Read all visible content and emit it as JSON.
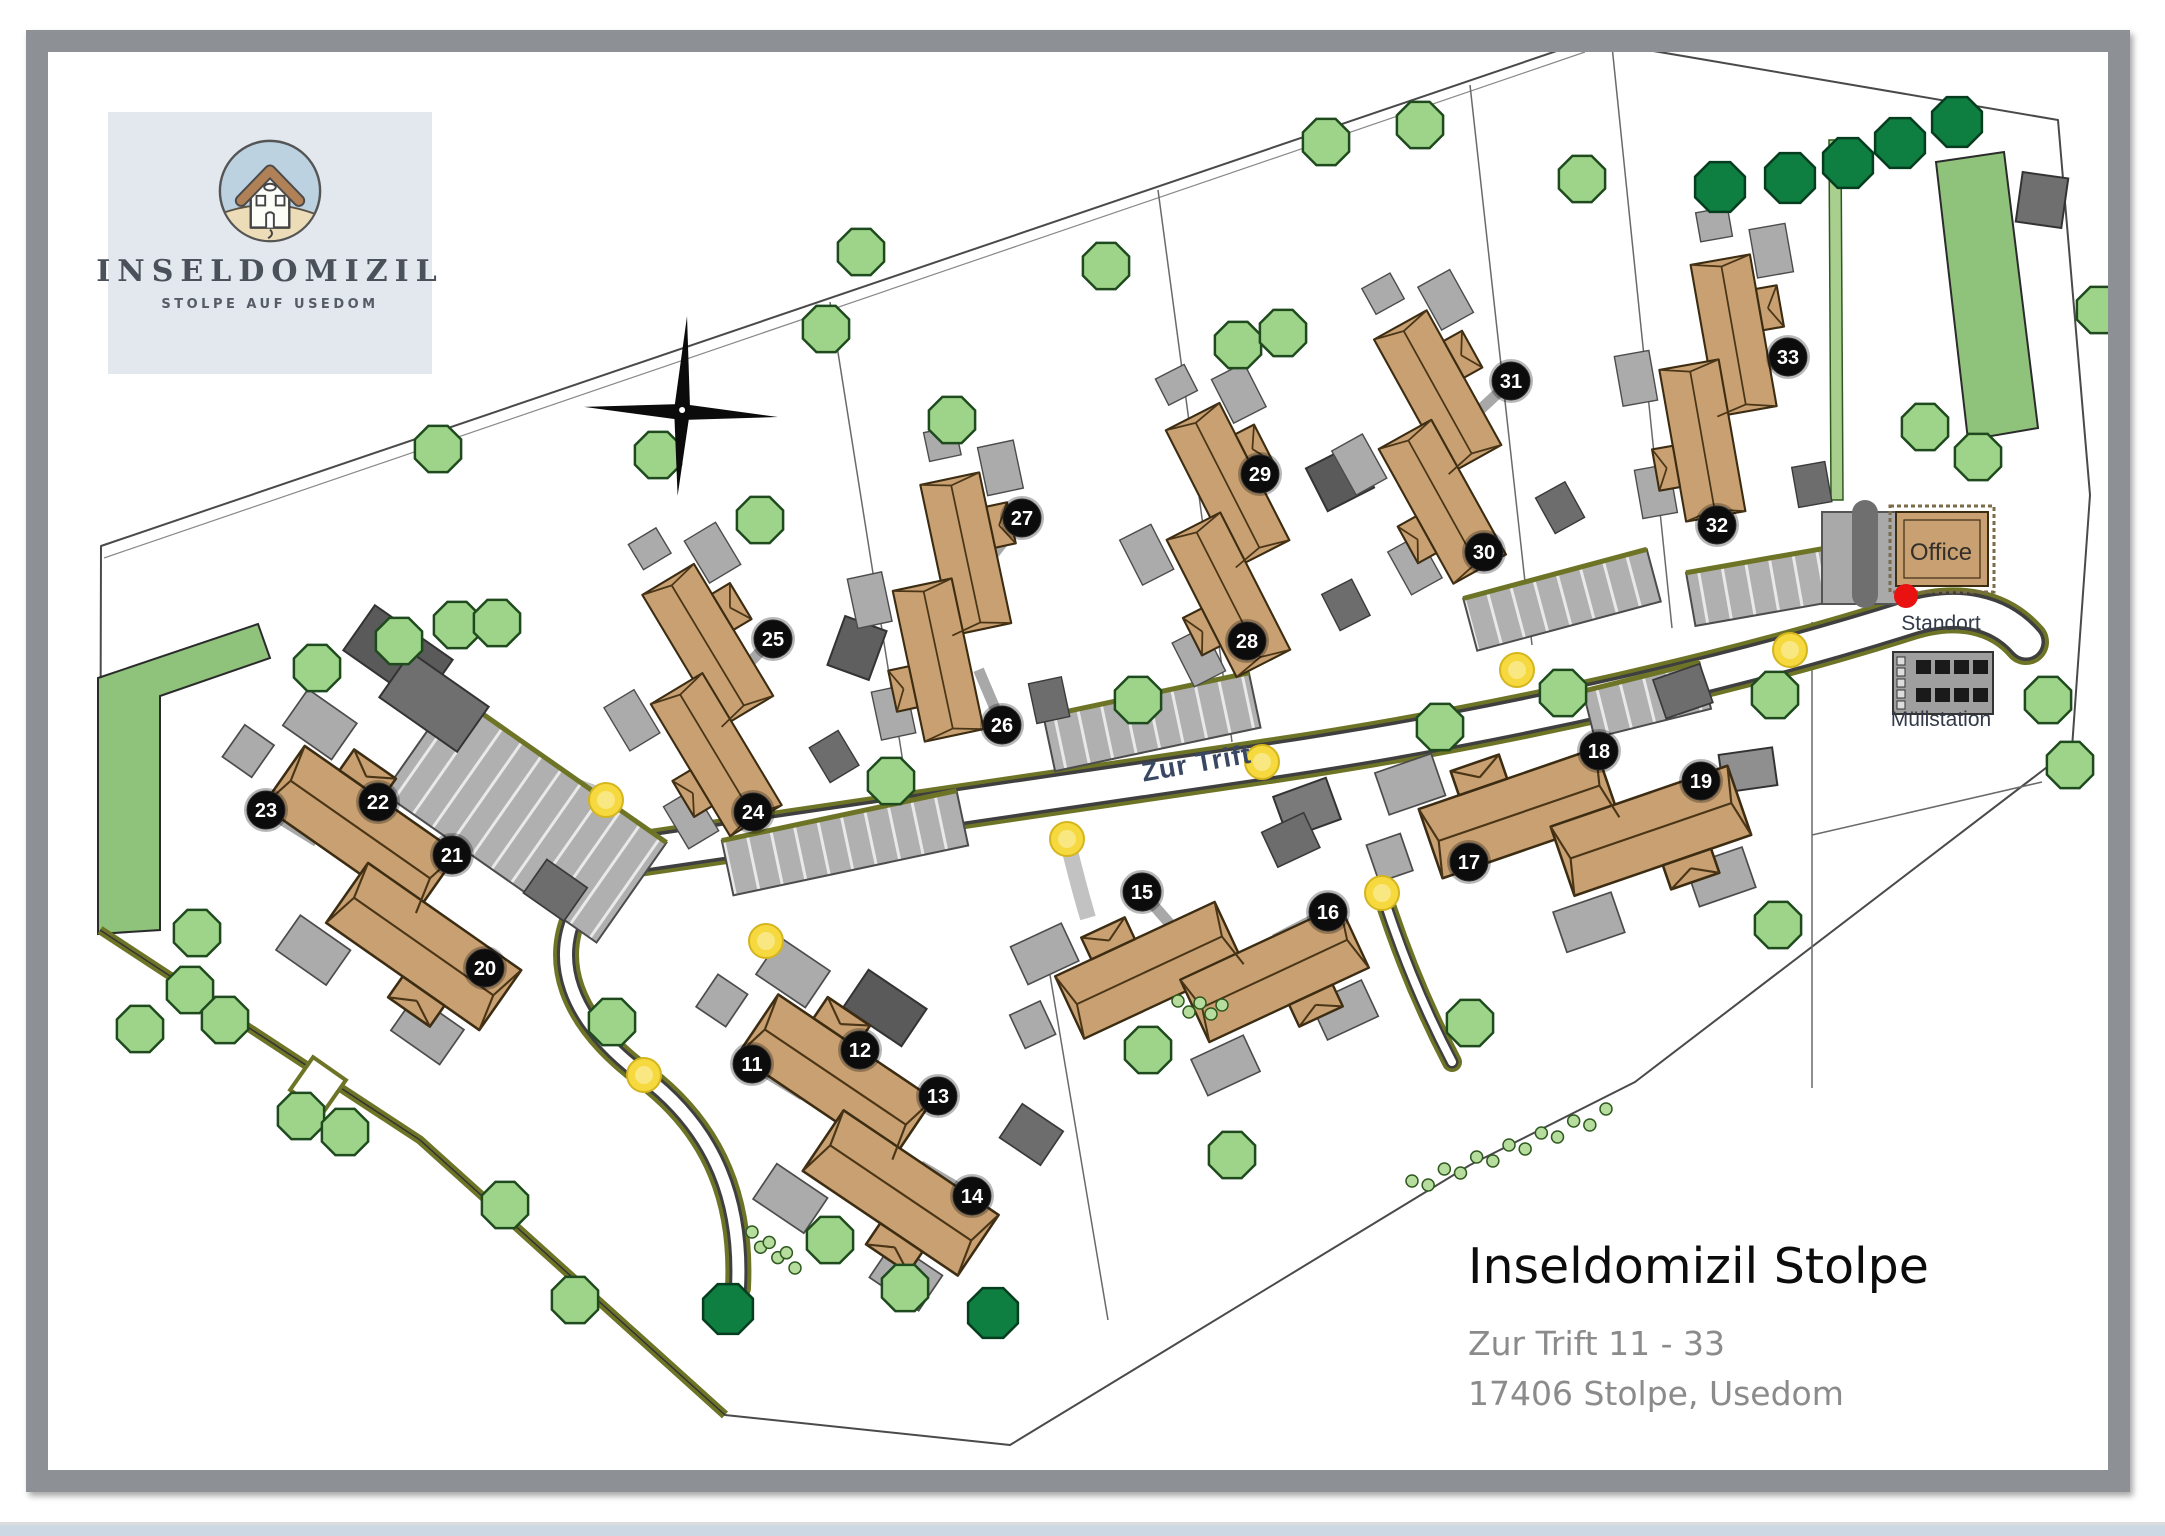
{
  "logo": {
    "title": "INSELDOMIZIL",
    "subtitle": "STOLPE AUF USEDOM"
  },
  "title_block": {
    "title": "Inseldomizil Stolpe",
    "address_line1": "Zur Trift 11 - 33",
    "address_line2": "17406 Stolpe, Usedom"
  },
  "map": {
    "labels": [
      {
        "text": "Zur Trift",
        "x": 1198,
        "y": 772,
        "rot": -10,
        "size": 27,
        "color": "#3a4763",
        "weight": "bold",
        "spacing": 1
      },
      {
        "text": "Office",
        "x": 1941,
        "y": 560,
        "rot": 0,
        "size": 24,
        "color": "#33302a",
        "weight": "normal",
        "spacing": 0
      },
      {
        "text": "Standort",
        "x": 1941,
        "y": 630,
        "rot": 0,
        "size": 21,
        "color": "#333a4a",
        "weight": "normal",
        "spacing": 0
      },
      {
        "text": "Müllstation",
        "x": 1941,
        "y": 726,
        "rot": 0,
        "size": 21,
        "color": "#333a4a",
        "weight": "normal",
        "spacing": 0
      }
    ],
    "markers": [
      {
        "n": "11",
        "x": 752,
        "y": 1064
      },
      {
        "n": "12",
        "x": 860,
        "y": 1050
      },
      {
        "n": "13",
        "x": 938,
        "y": 1096
      },
      {
        "n": "14",
        "x": 972,
        "y": 1196
      },
      {
        "n": "15",
        "x": 1142,
        "y": 892
      },
      {
        "n": "16",
        "x": 1328,
        "y": 912
      },
      {
        "n": "17",
        "x": 1469,
        "y": 862
      },
      {
        "n": "18",
        "x": 1599,
        "y": 751
      },
      {
        "n": "19",
        "x": 1701,
        "y": 781
      },
      {
        "n": "20",
        "x": 485,
        "y": 968
      },
      {
        "n": "21",
        "x": 452,
        "y": 855
      },
      {
        "n": "22",
        "x": 378,
        "y": 802
      },
      {
        "n": "23",
        "x": 266,
        "y": 810
      },
      {
        "n": "24",
        "x": 753,
        "y": 812
      },
      {
        "n": "25",
        "x": 773,
        "y": 639
      },
      {
        "n": "26",
        "x": 1002,
        "y": 725
      },
      {
        "n": "27",
        "x": 1022,
        "y": 518
      },
      {
        "n": "28",
        "x": 1247,
        "y": 641
      },
      {
        "n": "29",
        "x": 1260,
        "y": 474
      },
      {
        "n": "30",
        "x": 1484,
        "y": 552
      },
      {
        "n": "31",
        "x": 1511,
        "y": 381
      },
      {
        "n": "32",
        "x": 1717,
        "y": 525
      },
      {
        "n": "33",
        "x": 1788,
        "y": 357
      }
    ],
    "lamps": [
      [
        606,
        800
      ],
      [
        766,
        941
      ],
      [
        644,
        1075
      ],
      [
        1067,
        839
      ],
      [
        1262,
        762
      ],
      [
        1382,
        893
      ],
      [
        1517,
        670
      ],
      [
        1790,
        650
      ]
    ],
    "buildings": [
      {
        "x": 868,
        "y": 1135,
        "rot": 34,
        "s": 0.85
      },
      {
        "x": 1212,
        "y": 972,
        "rot": -25,
        "s": 0.8
      },
      {
        "x": 1585,
        "y": 822,
        "rot": -19,
        "s": 0.85
      },
      {
        "x": 392,
        "y": 888,
        "rot": 35,
        "s": 0.85
      },
      {
        "x": 712,
        "y": 700,
        "rot": 59,
        "s": 0.7
      },
      {
        "x": 952,
        "y": 607,
        "rot": 78,
        "s": 0.7
      },
      {
        "x": 1228,
        "y": 540,
        "rot": 63,
        "s": 0.7
      },
      {
        "x": 1440,
        "y": 447,
        "rot": 61,
        "s": 0.7
      },
      {
        "x": 1718,
        "y": 388,
        "rot": 80,
        "s": 0.7
      }
    ],
    "parking_strips": [
      {
        "x": 525,
        "y": 818,
        "l": 260,
        "t": 122,
        "rot": 35
      },
      {
        "x": 845,
        "y": 843,
        "l": 240,
        "t": 56,
        "rot": -12
      },
      {
        "x": 1152,
        "y": 722,
        "l": 210,
        "t": 56,
        "rot": -12
      },
      {
        "x": 1562,
        "y": 600,
        "l": 190,
        "t": 54,
        "rot": -15
      },
      {
        "x": 1772,
        "y": 585,
        "l": 165,
        "t": 54,
        "rot": -10
      },
      {
        "x": 1647,
        "y": 700,
        "l": 120,
        "t": 48,
        "rot": -14
      }
    ],
    "garages": [
      [
        398,
        655,
        95,
        55,
        35,
        "#5a5a5a"
      ],
      [
        434,
        702,
        95,
        55,
        35,
        "#6f6f6f"
      ],
      [
        857,
        648,
        44,
        52,
        20,
        "#5f5f5f"
      ],
      [
        1340,
        478,
        48,
        52,
        63,
        "#5a5a5a"
      ],
      [
        2042,
        200,
        46,
        50,
        8,
        "#6f6f6f"
      ],
      [
        1748,
        770,
        54,
        38,
        -8,
        "#8f8f8f"
      ],
      [
        885,
        1008,
        70,
        45,
        34,
        "#5a5a5a"
      ],
      [
        1307,
        808,
        56,
        44,
        -20,
        "#7a7a7a"
      ]
    ],
    "trees_light": [
      [
        317,
        668
      ],
      [
        457,
        625
      ],
      [
        497,
        623
      ],
      [
        197,
        933
      ],
      [
        190,
        990
      ],
      [
        225,
        1020
      ],
      [
        301,
        1116
      ],
      [
        345,
        1132
      ],
      [
        140,
        1029
      ],
      [
        399,
        641
      ],
      [
        438,
        449
      ],
      [
        658,
        455
      ],
      [
        760,
        520
      ],
      [
        826,
        329
      ],
      [
        861,
        252
      ],
      [
        952,
        420
      ],
      [
        1106,
        266
      ],
      [
        1238,
        345
      ],
      [
        1283,
        333
      ],
      [
        1326,
        142
      ],
      [
        1420,
        125
      ],
      [
        1582,
        179
      ],
      [
        612,
        1022
      ],
      [
        830,
        1240
      ],
      [
        905,
        1288
      ],
      [
        1148,
        1050
      ],
      [
        1232,
        1155
      ],
      [
        1440,
        727
      ],
      [
        1563,
        693
      ],
      [
        1775,
        695
      ],
      [
        1778,
        925
      ],
      [
        2048,
        700
      ],
      [
        2070,
        765
      ],
      [
        1925,
        427
      ],
      [
        1978,
        457
      ],
      [
        2100,
        310
      ],
      [
        891,
        781
      ],
      [
        1138,
        700
      ],
      [
        1470,
        1023
      ],
      [
        505,
        1205
      ],
      [
        575,
        1300
      ]
    ],
    "trees_dark": [
      [
        1720,
        187
      ],
      [
        1790,
        178
      ],
      [
        1848,
        163
      ],
      [
        1900,
        143
      ],
      [
        1957,
        122
      ],
      [
        993,
        1313
      ],
      [
        728,
        1309
      ]
    ],
    "bush_chains": [
      [
        1412,
        1186,
        1606,
        1114,
        13
      ],
      [
        752,
        1237,
        795,
        1263,
        6
      ],
      [
        1178,
        1006,
        1222,
        1010,
        5
      ]
    ],
    "colors": {
      "building": "#c8a071",
      "building_outline": "#3c2c12",
      "roof_line": "#4a3517",
      "pad": "#ababab",
      "garage": "#6d6d6d",
      "tree_light": "#9ed489",
      "tree_dark": "#0f7f41",
      "tree_outline": "#1e4a1e",
      "meadow": "#8fc27a",
      "hedge": "#a9cf8f",
      "road_olive": "#6e7426",
      "road_edge": "#3f3f3f",
      "marker_bg": "#0c0c0c",
      "marker_text": "#ffffff",
      "lamp": "#f6d93e",
      "lamp_inner": "#fae98a",
      "standort_red": "#ea1111",
      "boundary": "#4a4a4a",
      "divider": "#6a6a6a"
    }
  }
}
